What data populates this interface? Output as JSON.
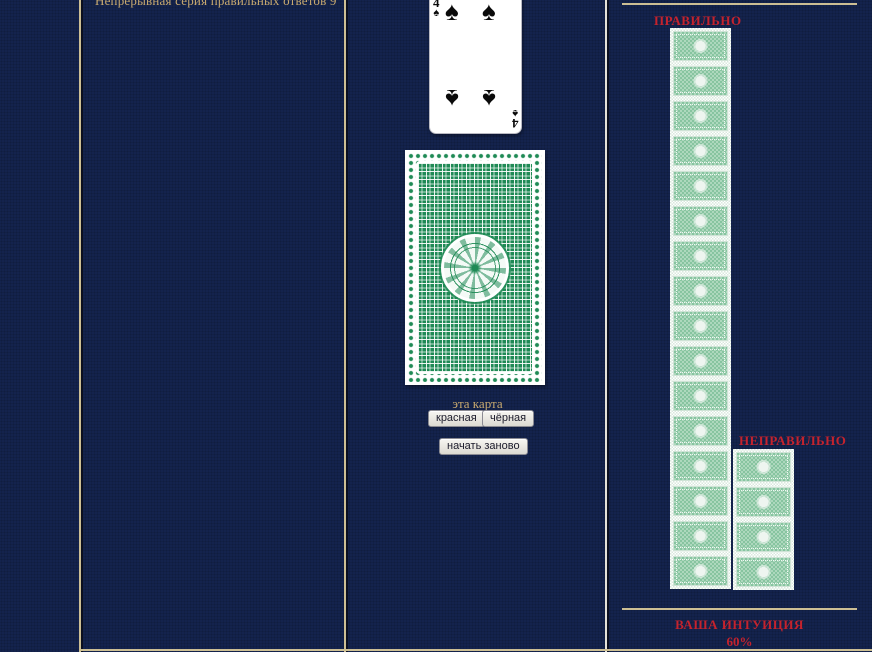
{
  "left_panel": {
    "streak_text": "Непрерывная серия правильных ответов 9"
  },
  "center_panel": {
    "revealed_card": {
      "rank": "4",
      "suit_symbol": "♠"
    },
    "prompt_label": "эта карта",
    "red_button": "красная",
    "black_button": "чёрная",
    "restart_button": "начать заново"
  },
  "right_panel": {
    "correct_label": "ПРАВИЛЬНО",
    "correct_count": 16,
    "incorrect_label": "НЕПРАВИЛЬНО",
    "incorrect_count": 4,
    "intuition_label": "ВАША ИНТУИЦИЯ",
    "intuition_value": "60%"
  },
  "colors": {
    "background": "#14234d",
    "frame_line": "#cdbf94",
    "label_red": "#c5232d",
    "text_tan": "#c9aa70",
    "card_back_green": "#1f8a55"
  }
}
